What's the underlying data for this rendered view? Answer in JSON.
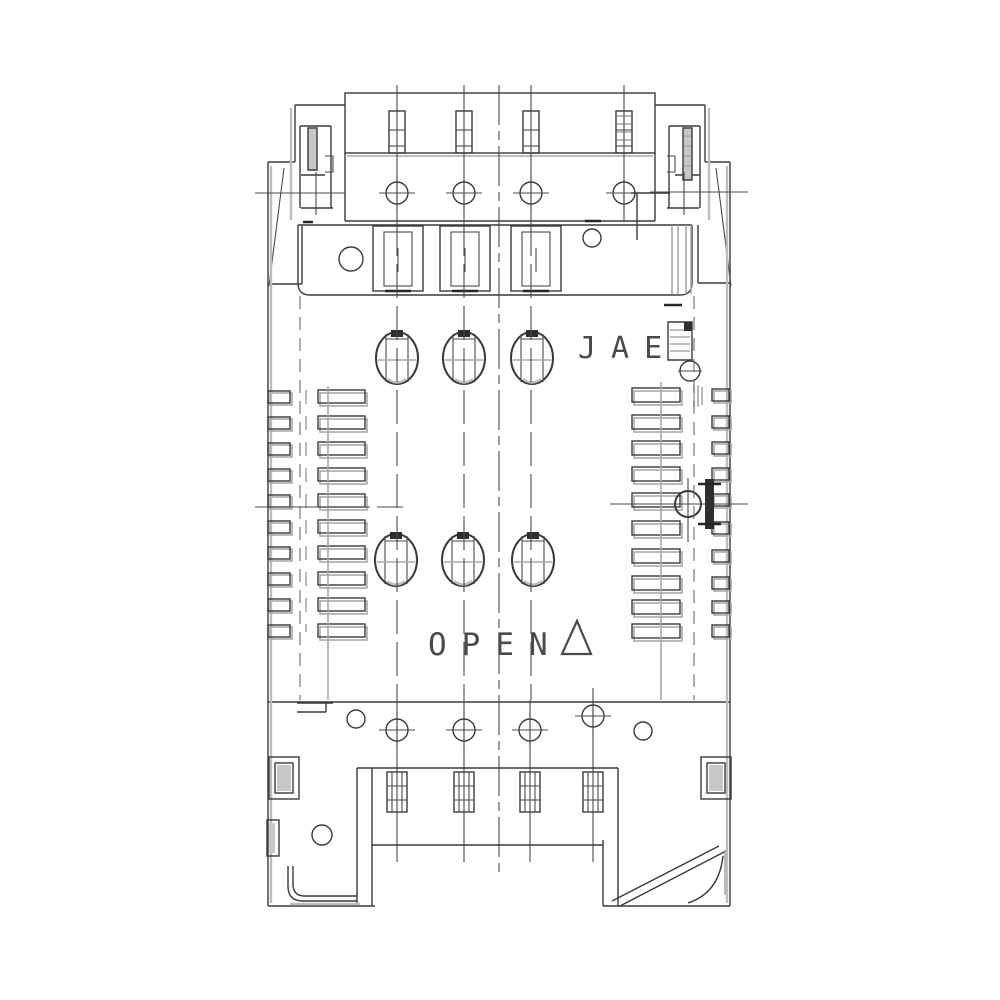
{
  "drawing": {
    "brand_label": "JAE",
    "open_label": "OPEN",
    "icons": {
      "open_direction_mark": "open-triangle-icon"
    },
    "colors": {
      "background": "#ffffff",
      "line": "#3a3a3a",
      "shade": "#a9a9a9",
      "text": "#4a4a4a"
    }
  }
}
